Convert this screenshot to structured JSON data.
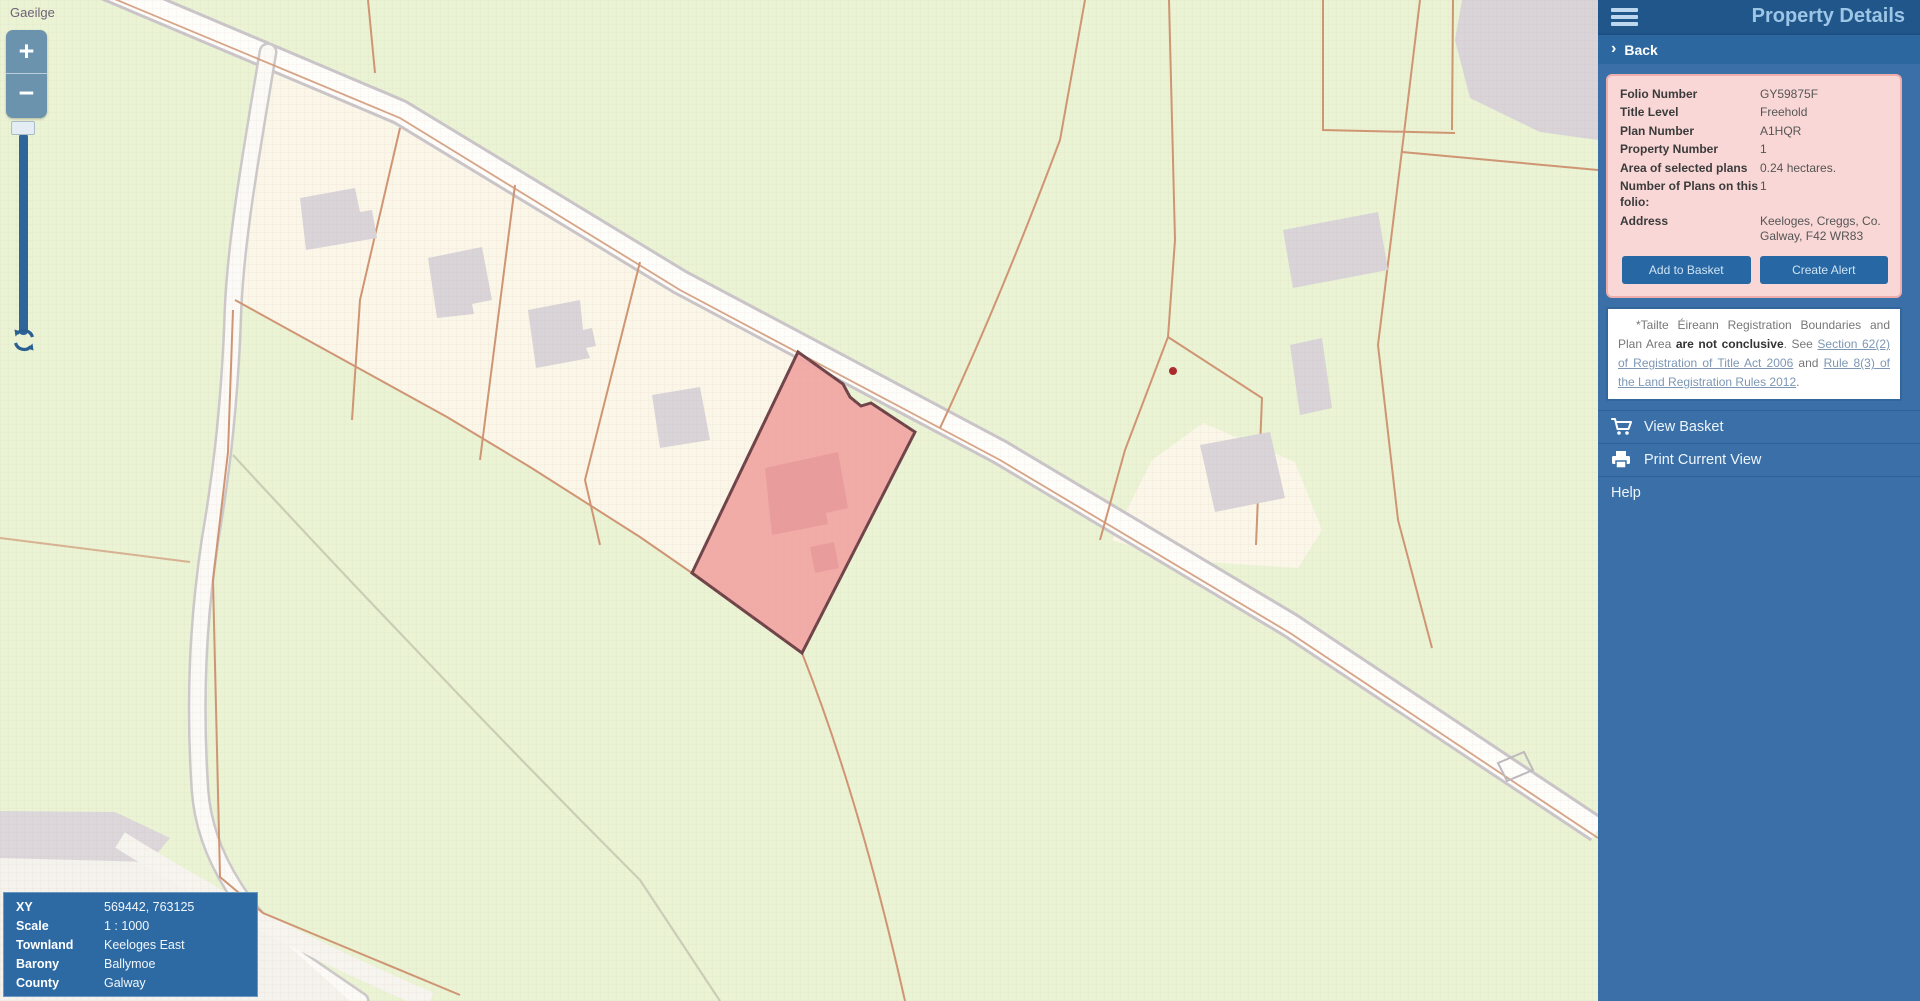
{
  "map_controls": {
    "language_link": "Gaeilge",
    "zoom_in": "+",
    "zoom_out": "−"
  },
  "coords_panel": {
    "rows": [
      {
        "label": "XY",
        "value": "569442, 763125"
      },
      {
        "label": "Scale",
        "value": "1 : 1000"
      },
      {
        "label": "Townland",
        "value": "Keeloges East"
      },
      {
        "label": "Barony",
        "value": "Ballymoe"
      },
      {
        "label": "County",
        "value": "Galway"
      }
    ]
  },
  "sidebar": {
    "title": "Property Details",
    "back_label": "Back",
    "back_chevron": "›",
    "details": {
      "rows": [
        {
          "label": "Folio Number",
          "value": "GY59875F"
        },
        {
          "label": "Title Level",
          "value": "Freehold"
        },
        {
          "label": "Plan Number",
          "value": "A1HQR"
        },
        {
          "label": "Property Number",
          "value": "1"
        },
        {
          "label": "Area of selected plans",
          "value": "0.24 hectares."
        },
        {
          "label": "Number of Plans on this folio:",
          "value": "1"
        },
        {
          "label": "Address",
          "value": "Keeloges, Creggs, Co. Galway, F42 WR83"
        }
      ],
      "buttons": [
        "Add to Basket",
        "Create Alert"
      ]
    },
    "disclaimer": {
      "prefix": "*Tailte Éireann Registration Boundaries and Plan Area ",
      "bold": "are not conclusive",
      "mid": ". See ",
      "link1": "Section 62(2) of Registration of Title Act 2006",
      "and_word": " and ",
      "link2": "Rule 8(3) of the Land Registration Rules 2012",
      "suffix": "."
    },
    "menu": {
      "view_basket": "View Basket",
      "print_view": "Print Current View",
      "help": "Help"
    }
  },
  "colors": {
    "sidebar_header": "#20568a",
    "sidebar_body": "#3a70a7",
    "panel_pink": "#f8d7d6",
    "button_blue": "#2767a3",
    "map_background": "#eaf3d4",
    "parcel_cream": "#faf6e8",
    "boundary_orange": "#cf9573",
    "selected_parcel_fill": "#f2a6a4",
    "selected_parcel_border": "#6f4449",
    "building_gray": "#d8d4d8"
  }
}
